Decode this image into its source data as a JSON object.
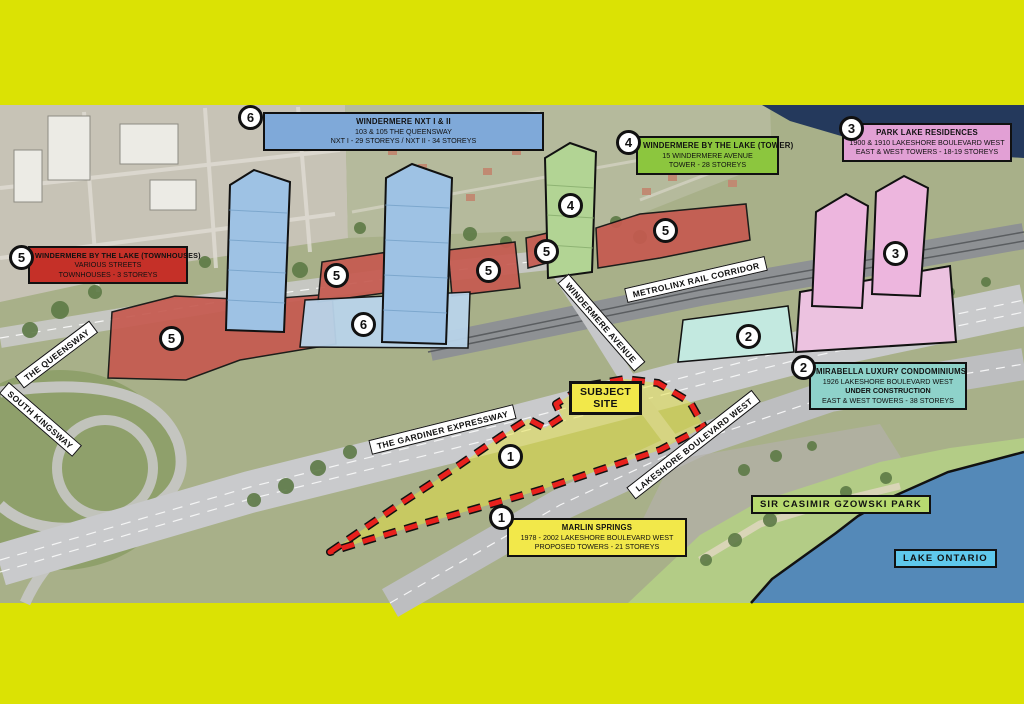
{
  "colors": {
    "page_border": "#dbe204",
    "subject_outline_red": "#e8211d",
    "subject_fill_yellow": "#e6e13c",
    "callout_blue": "#7fa9d9",
    "callout_green": "#8cc63e",
    "callout_pink": "#e2a0d5",
    "callout_red": "#c53028",
    "callout_teal": "#8ed2ca",
    "callout_yellow": "#f2e84a",
    "lake_label_blue": "#5fc8ec",
    "park_label_green": "#b8da70",
    "marker_bg": "#ffffff",
    "marker_border": "#111111"
  },
  "callouts": {
    "nxt": {
      "title": "WINDERMERE NXT I & II",
      "line1": "103 & 105 THE QUEENSWAY",
      "line2": "NXT I - 29 STOREYS / NXT II - 34 STOREYS"
    },
    "tower": {
      "title": "WINDERMERE BY THE LAKE (TOWER)",
      "line1": "15 WINDERMERE AVENUE",
      "line2": "TOWER - 28 STOREYS"
    },
    "parklake": {
      "title": "PARK LAKE RESIDENCES",
      "line1": "1900 & 1910 LAKESHORE BOULEVARD WEST",
      "line2": "EAST & WEST TOWERS - 18-19 STOREYS"
    },
    "townhouses": {
      "title": "WINDERMERE BY THE LAKE (TOWNHOUSES)",
      "line1": "VARIOUS STREETS",
      "line2": "TOWNHOUSES - 3 STOREYS"
    },
    "mirabella": {
      "title": "MIRABELLA LUXURY CONDOMINIUMS",
      "line1": "1926 LAKESHORE BOULEVARD WEST",
      "line2": "UNDER CONSTRUCTION",
      "line3": "EAST & WEST TOWERS - 38 STOREYS"
    },
    "marlin": {
      "title": "MARLIN SPRINGS",
      "line1": "1978 - 2002 LAKESHORE BOULEVARD WEST",
      "line2": "PROPOSED TOWERS - 21 STOREYS"
    }
  },
  "subject_site": {
    "line1": "SUBJECT",
    "line2": "SITE"
  },
  "roads": {
    "queensway": "THE QUEENSWAY",
    "south_kingsway": "SOUTH KINGSWAY",
    "gardiner": "THE GARDINER EXPRESSWAY",
    "metrolinx": "METROLINX RAIL CORRIDOR",
    "windermere": "WINDERMERE AVENUE",
    "lakeshore": "LAKESHORE BOULEVARD WEST"
  },
  "areas": {
    "park": "SIR CASIMIR GZOWSKI PARK",
    "lake": "LAKE ONTARIO"
  },
  "markers": [
    "6",
    "6",
    "4",
    "4",
    "3",
    "3",
    "5",
    "5",
    "5",
    "5",
    "5",
    "5",
    "2",
    "2",
    "1",
    "1"
  ]
}
